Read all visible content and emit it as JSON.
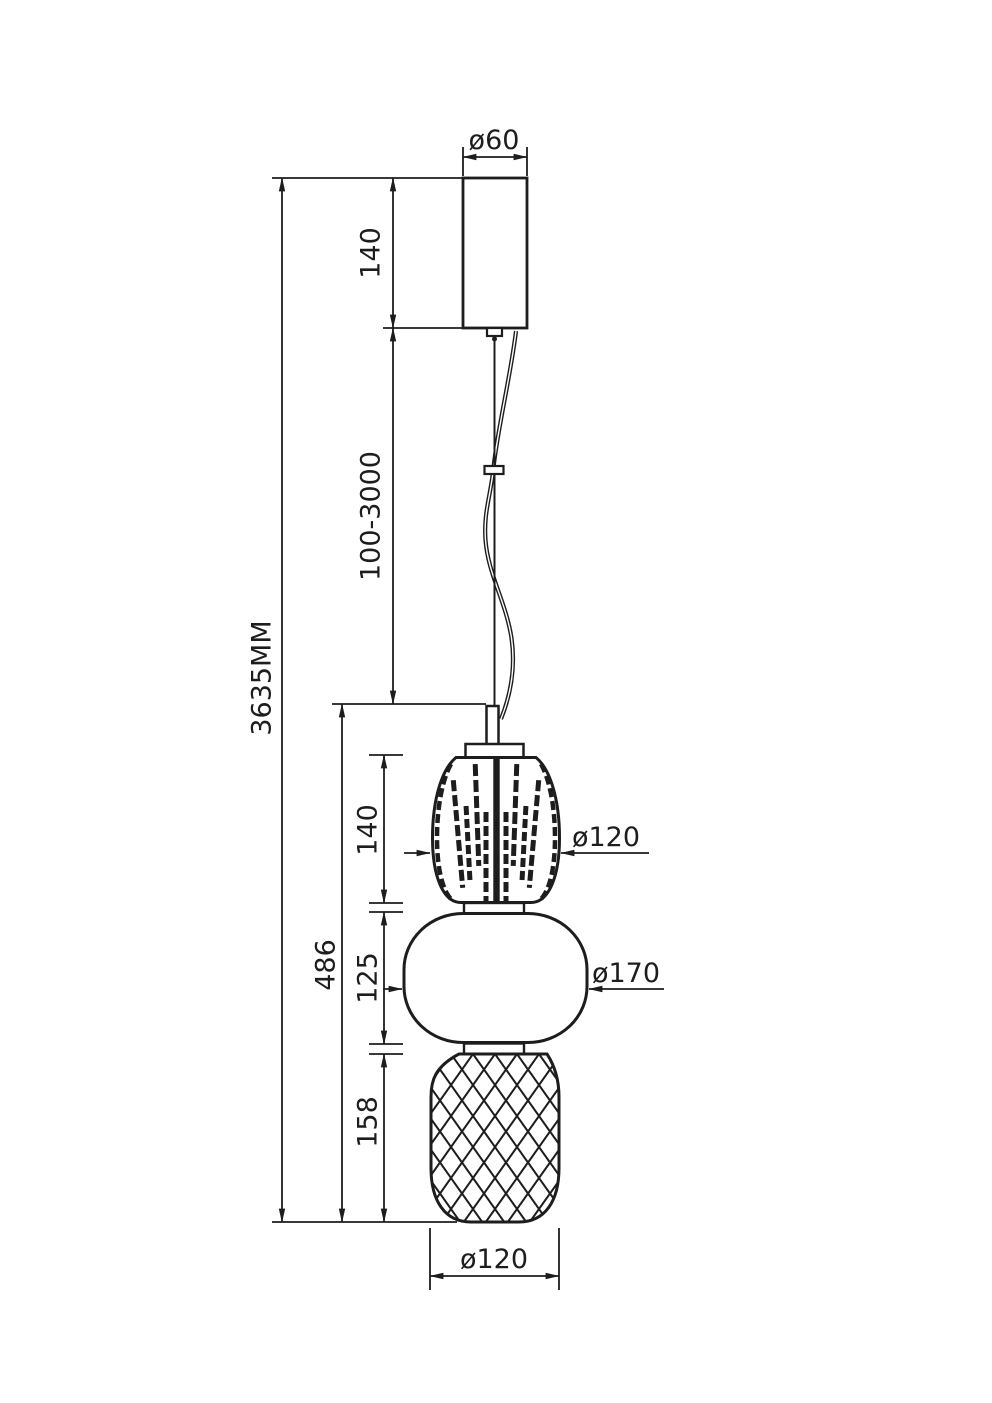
{
  "drawing": {
    "type": "pendant-lamp-technical-drawing",
    "units": "mm",
    "colors": {
      "line": "#1d1d1d",
      "background": "#ffffff"
    },
    "labels": {
      "canopy_diameter": "ø60",
      "canopy_height": "140",
      "cable_length_range": "100-3000",
      "overall_height": "3635MM",
      "fixture_height": "486",
      "top_shade_height": "140",
      "top_shade_diameter": "ø120",
      "middle_shade_height": "125",
      "middle_shade_diameter": "ø170",
      "bottom_shade_height": "158",
      "bottom_shade_diameter": "ø120"
    }
  }
}
